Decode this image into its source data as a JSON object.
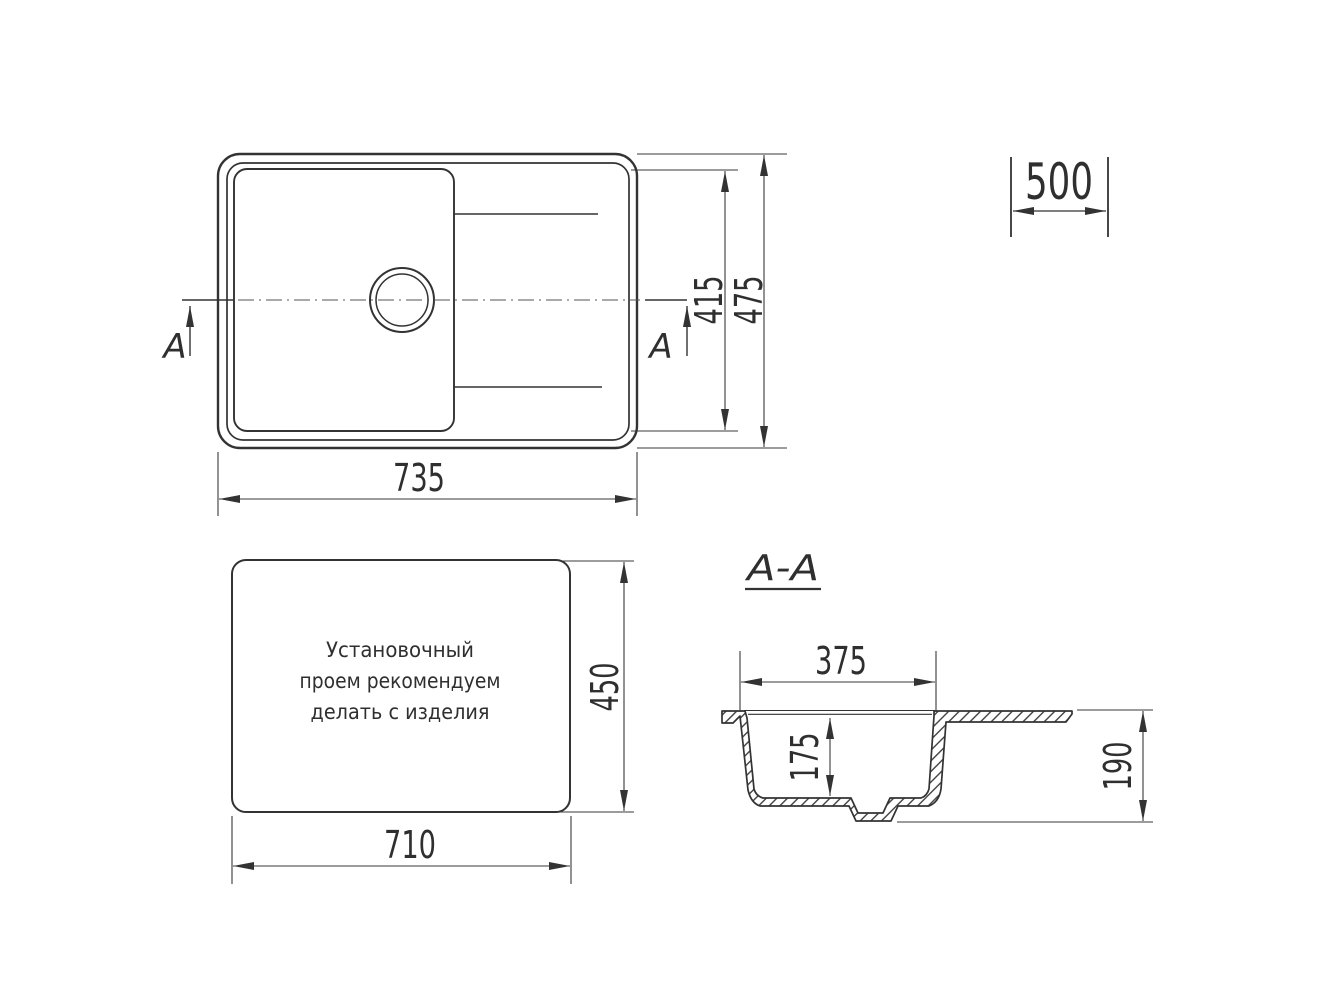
{
  "drawing": {
    "kind": "kitchen sink installation drawing",
    "colors": {
      "background": "#ffffff",
      "line": "#333333",
      "text": "#2f2f2f"
    }
  },
  "top_view": {
    "dim_overall_width": "735",
    "dim_overall_depth": "475",
    "dim_inner_depth": "415",
    "section_label_left": "A",
    "section_label_right": "A"
  },
  "base_cabinet": {
    "dim_width": "500"
  },
  "install_opening": {
    "note_line1": "Установочный",
    "note_line2": "проем рекомендуем",
    "note_line3": "делать с изделия",
    "dim_width": "710",
    "dim_depth": "450"
  },
  "section": {
    "title": "A-A",
    "dim_bowl_width": "375",
    "dim_bowl_depth": "175",
    "dim_overall_height": "190"
  }
}
